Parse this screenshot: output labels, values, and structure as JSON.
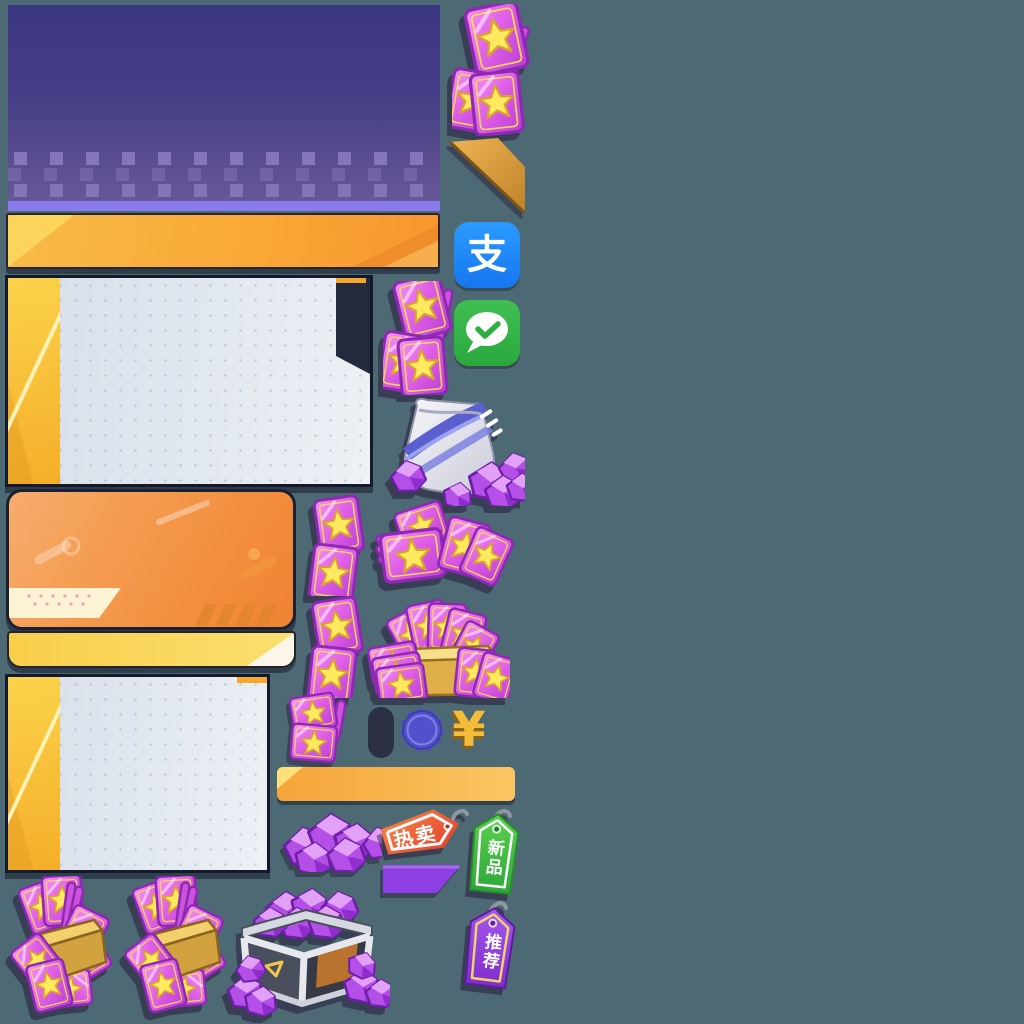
{
  "app": {
    "name": "game-shop-sprite-atlas"
  },
  "canvas": {
    "width": 1024,
    "height": 1024,
    "background": "#4d6973"
  },
  "colors": {
    "promo_panel_top": "#3c3781",
    "promo_panel_bottom": "#665797",
    "lavender_strip": "#8a7cec",
    "banner_orange": "#f9a937",
    "card_body": "#e2e8f0",
    "card_stripe_yellow": "#f8c238",
    "corner_notch_navy": "#232a3b",
    "sale_card_orange": "#f28c3b",
    "footer_bar_yellow": "#f9d85c",
    "ticket_magenta": "#d94fe0",
    "ticket_star_yellow": "#ffe95e",
    "gem_purple": "#b44fe8",
    "gold": "#d2a23f",
    "coin_indigo": "#5152cb",
    "capsule_navy": "#2b3143",
    "alipay_blue": "#1e86f7",
    "wechat_green": "#35b24a",
    "hot_tag_red": "#ee5633",
    "new_tag_green": "#3fbf43",
    "recommend_tag_purple": "#9146dd"
  },
  "payment": {
    "alipay": {
      "glyph": "支"
    },
    "wechat": {}
  },
  "tags": {
    "hot": {
      "label": "热卖"
    },
    "new": {
      "label": "新品"
    },
    "recommend": {
      "label": "推荐"
    }
  },
  "currency": {
    "yuan_symbol": "¥"
  },
  "assets": {
    "panels": [
      "promo-banner-panel",
      "content-card-large",
      "sale-card-orange",
      "content-card-small"
    ],
    "buttons": [
      "orange-banner-button",
      "yellow-footer-bar",
      "orange-bar-button"
    ],
    "icons": [
      "ticket-stack",
      "ticket-pair",
      "ticket-pile",
      "ticket-pile-gold-box",
      "ticket-bundle",
      "gem",
      "gem-pile",
      "gem-pouch",
      "gem-crate",
      "gold-corner-ribbon",
      "indigo-coin",
      "navy-capsule",
      "yuan-symbol",
      "purple-parallelogram",
      "alipay-icon",
      "wechat-pay-icon",
      "hot-sale-tag",
      "new-item-tag",
      "recommend-tag"
    ]
  }
}
